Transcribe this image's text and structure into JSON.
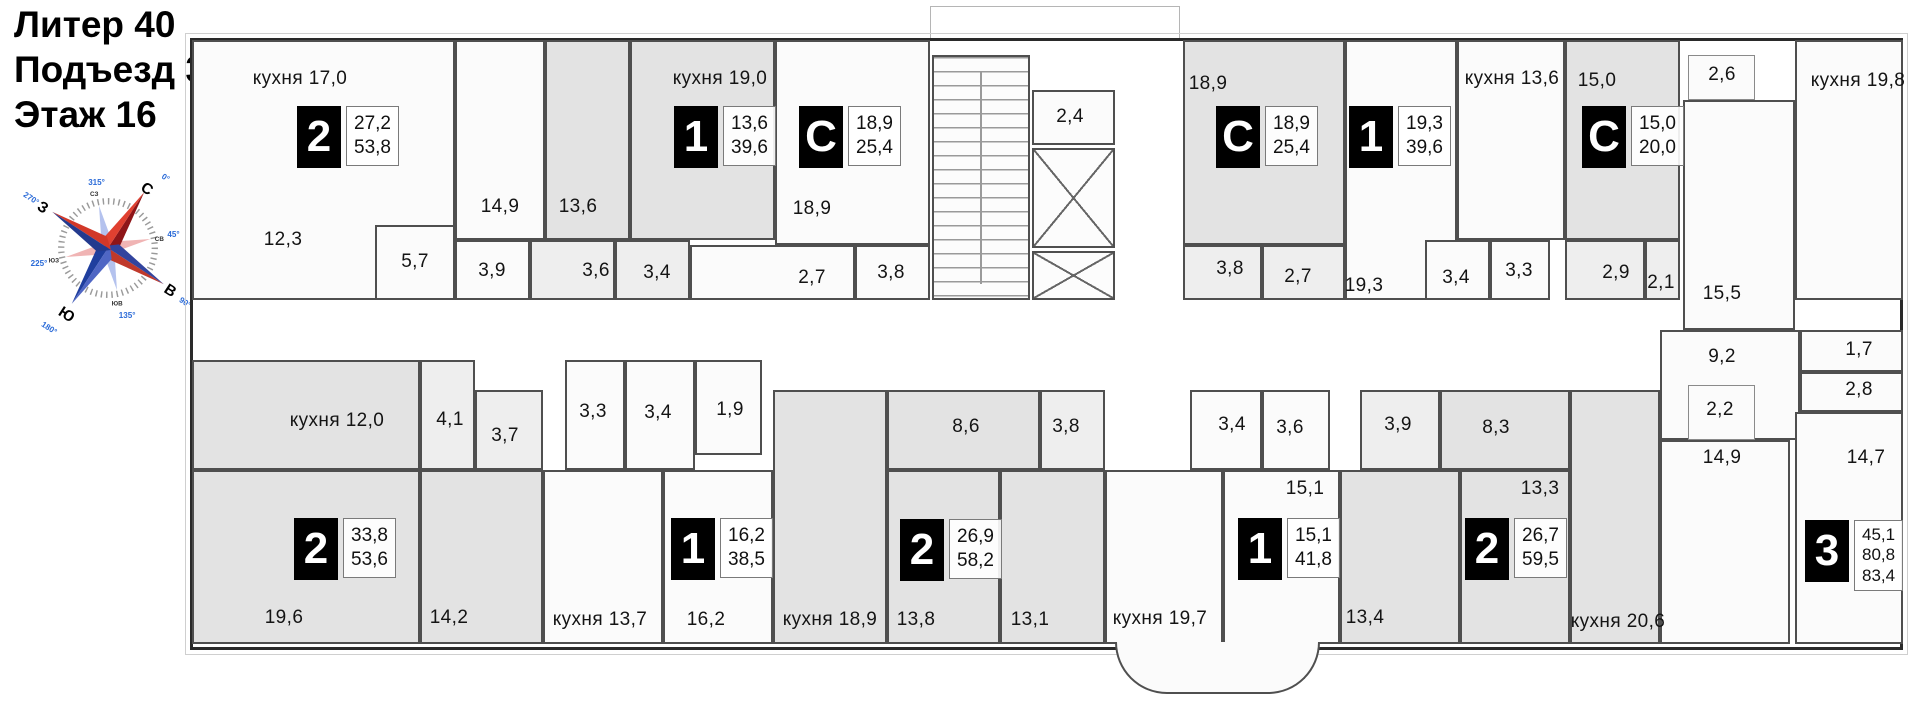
{
  "title": {
    "lines": [
      "Литер 40",
      "Подъезд 3",
      "Этаж 16"
    ]
  },
  "compass": {
    "cardinal": [
      {
        "dir": "С",
        "deg": "0°"
      },
      {
        "dir": "В",
        "deg": "90°"
      },
      {
        "dir": "Ю",
        "deg": "180°"
      },
      {
        "dir": "З",
        "deg": "270°"
      }
    ],
    "intercardinal": [
      {
        "dir": "СЗ",
        "deg": "315°"
      },
      {
        "dir": "СВ",
        "deg": "45°"
      },
      {
        "dir": "ЮЗ",
        "deg": "225°"
      },
      {
        "dir": "ЮВ",
        "deg": "135°"
      }
    ]
  },
  "colors": {
    "badge_bg": "#000000",
    "badge_text": "#ffffff",
    "compass_red": "#c0392b",
    "compass_blue": "#1f3e9e",
    "room_gray": "#e3e3e3",
    "wall": "#4f4f4f"
  },
  "apartments": [
    {
      "type": "2",
      "living": "27,2",
      "total": "53,8"
    },
    {
      "type": "1",
      "living": "13,6",
      "total": "39,6"
    },
    {
      "type": "С",
      "living": "18,9",
      "total": "25,4"
    },
    {
      "type": "С",
      "living": "18,9",
      "total": "25,4"
    },
    {
      "type": "1",
      "living": "19,3",
      "total": "39,6"
    },
    {
      "type": "С",
      "living": "15,0",
      "total": "20,0"
    },
    {
      "type": "2",
      "living": "33,8",
      "total": "53,6"
    },
    {
      "type": "1",
      "living": "16,2",
      "total": "38,5"
    },
    {
      "type": "2",
      "living": "26,9",
      "total": "58,2"
    },
    {
      "type": "1",
      "living": "15,1",
      "total": "41,8"
    },
    {
      "type": "2",
      "living": "26,7",
      "total": "59,5"
    },
    {
      "type": "3",
      "living": "45,1",
      "total": "80,8",
      "total2": "83,4"
    }
  ],
  "rooms": {
    "kuh17": "кухня 17,0",
    "a1_12_3": "12,3",
    "a1_5_7": "5,7",
    "a1_14_9": "14,9",
    "a1_3_9": "3,9",
    "a2_13_6": "13,6",
    "a2_3_6": "3,6",
    "a2_3_4": "3,4",
    "kuh19_0": "кухня 19,0",
    "a3_18_9": "18,9",
    "a3_2_7": "2,7",
    "a3_3_8": "3,8",
    "core_2_4": "2,4",
    "a4_18_9": "18,9",
    "a4_3_8": "3,8",
    "a4_2_7": "2,7",
    "a5_19_3": "19,3",
    "a5_3_4": "3,4",
    "a5_3_3": "3,3",
    "kuh13_6": "кухня 13,6",
    "a6_15_0": "15,0",
    "a6_2_9": "2,9",
    "a6_2_1": "2,1",
    "balc_2_6": "2,6",
    "kuh19_8": "кухня 19,8",
    "a7_15_5": "15,5",
    "a7_9_2": "9,2",
    "a7_2_2": "2,2",
    "a7_14_9": "14,9",
    "a7_1_7": "1,7",
    "a7_2_8": "2,8",
    "a7_14_7": "14,7",
    "kuh12_0": "кухня 12,0",
    "b1_4_1": "4,1",
    "b1_3_7": "3,7",
    "b1_19_6": "19,6",
    "b1_14_2": "14,2",
    "b2_3_3": "3,3",
    "b2_3_4": "3,4",
    "b2_1_9": "1,9",
    "kuh13_7": "кухня 13,7",
    "b2_16_2": "16,2",
    "b3_8_6": "8,6",
    "b3_3_8": "3,8",
    "kuh18_9": "кухня 18,9",
    "b3_13_8": "13,8",
    "b3_13_1": "13,1",
    "b4_3_4": "3,4",
    "b4_3_6": "3,6",
    "b4_15_1": "15,1",
    "kuh19_7": "кухня 19,7",
    "b5_3_9": "3,9",
    "b5_8_3": "8,3",
    "b5_13_3": "13,3",
    "b5_13_4": "13,4",
    "kuh20_6": "кухня 20,6"
  }
}
